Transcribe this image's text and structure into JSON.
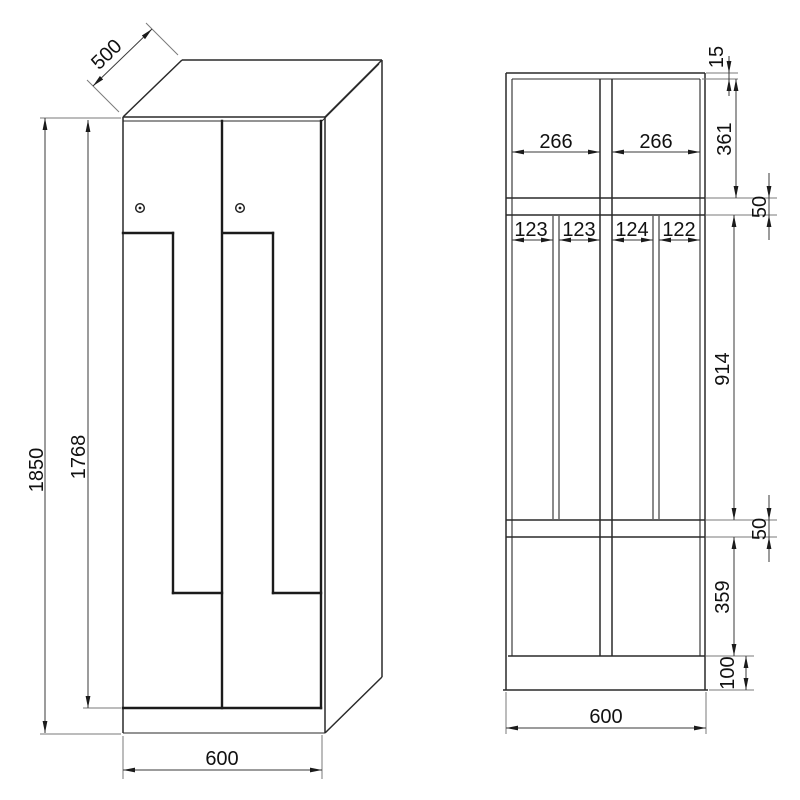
{
  "front_view": {
    "dim_depth": "500",
    "dim_total_height": "1850",
    "dim_door_height": "1768",
    "dim_width": "600"
  },
  "section_view": {
    "dim_top_panel": "15",
    "dim_upper_compartment_height": "361",
    "dim_upper_shelf_thickness": "50",
    "dim_middle_compartment_height": "914",
    "dim_lower_shelf_thickness": "50",
    "dim_lower_compartment_height": "359",
    "dim_plinth_height": "100",
    "dim_upper_width_left": "266",
    "dim_upper_width_right": "266",
    "dim_slot_1": "123",
    "dim_slot_2": "123",
    "dim_slot_3": "124",
    "dim_slot_4": "122",
    "dim_width": "600"
  },
  "colors": {
    "outline": "#2a2a2a",
    "dimension_line": "#3a3a3a",
    "extension_line": "#7a7a7a",
    "text": "#111111",
    "background": "#ffffff"
  }
}
